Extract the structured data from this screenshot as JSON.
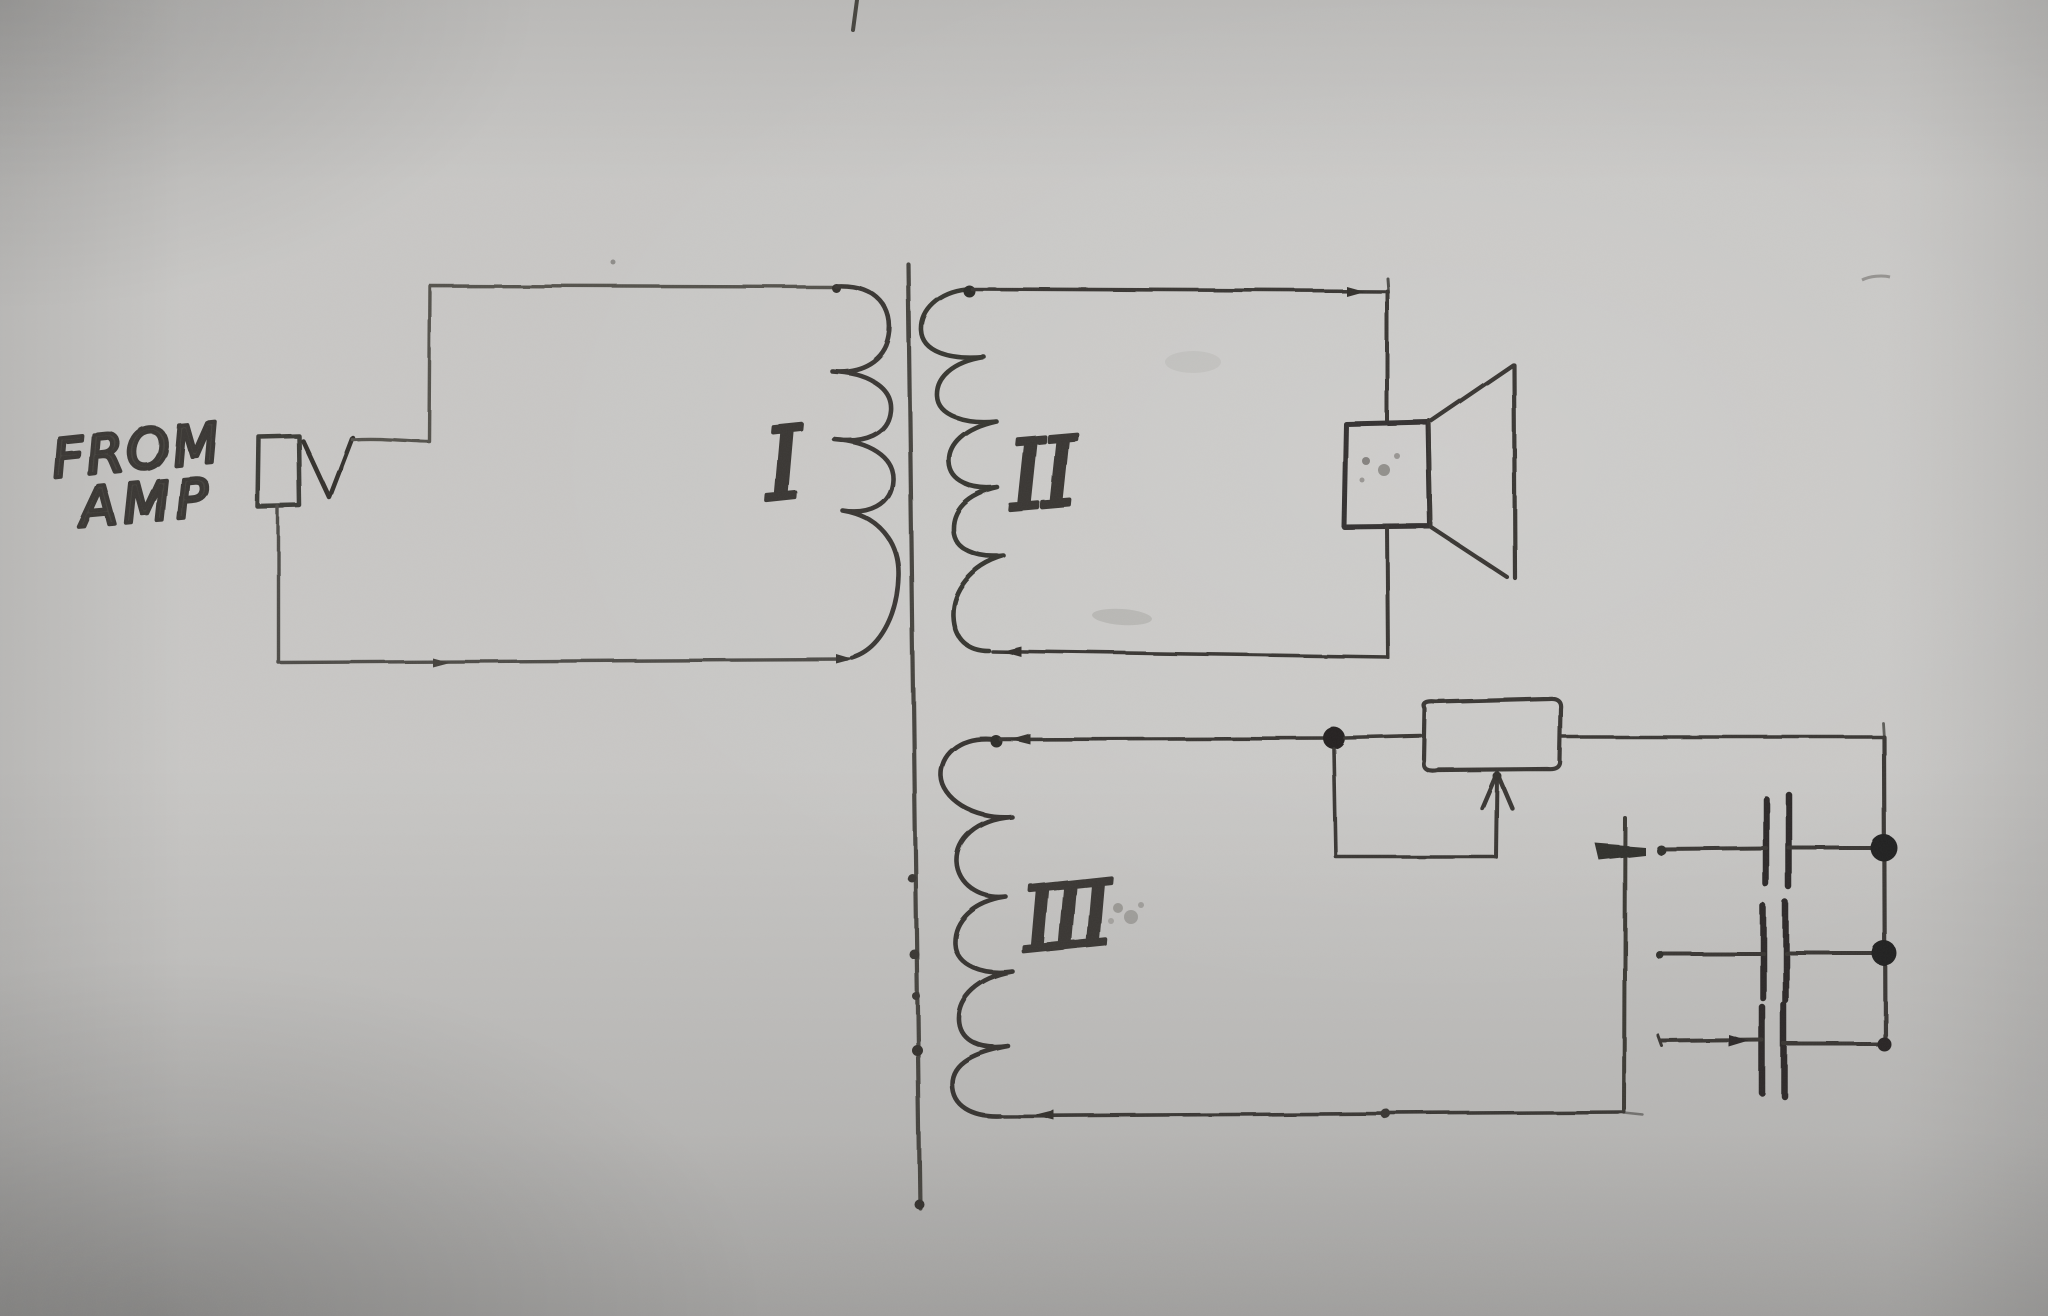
{
  "labels": {
    "source_line1": "FROM",
    "source_line2": "AMP",
    "winding_1": "I",
    "winding_2": "II",
    "winding_3": "III"
  },
  "colors": {
    "paper": "#c9c8c6",
    "ink": "#3b3935",
    "ink_dark": "#2c2a27"
  },
  "diagram": {
    "type": "hand-drawn transformer schematic",
    "input_label": "FROM AMP",
    "windings": [
      {
        "label": "I",
        "turns_drawn": 4,
        "connected_to": "amplifier input jack"
      },
      {
        "label": "II",
        "turns_drawn": 5,
        "connected_to": "speaker"
      },
      {
        "label": "III",
        "turns_drawn": 5,
        "connected_to": "potentiometer and capacitor bank"
      }
    ],
    "components": [
      "input-jack",
      "check-mark-connector",
      "transformer-core",
      "speaker",
      "potentiometer",
      "wiper-arrow",
      "capacitor-1",
      "capacitor-2",
      "capacitor-3",
      "junction-dot-1",
      "junction-dot-2",
      "junction-dot-3"
    ]
  }
}
